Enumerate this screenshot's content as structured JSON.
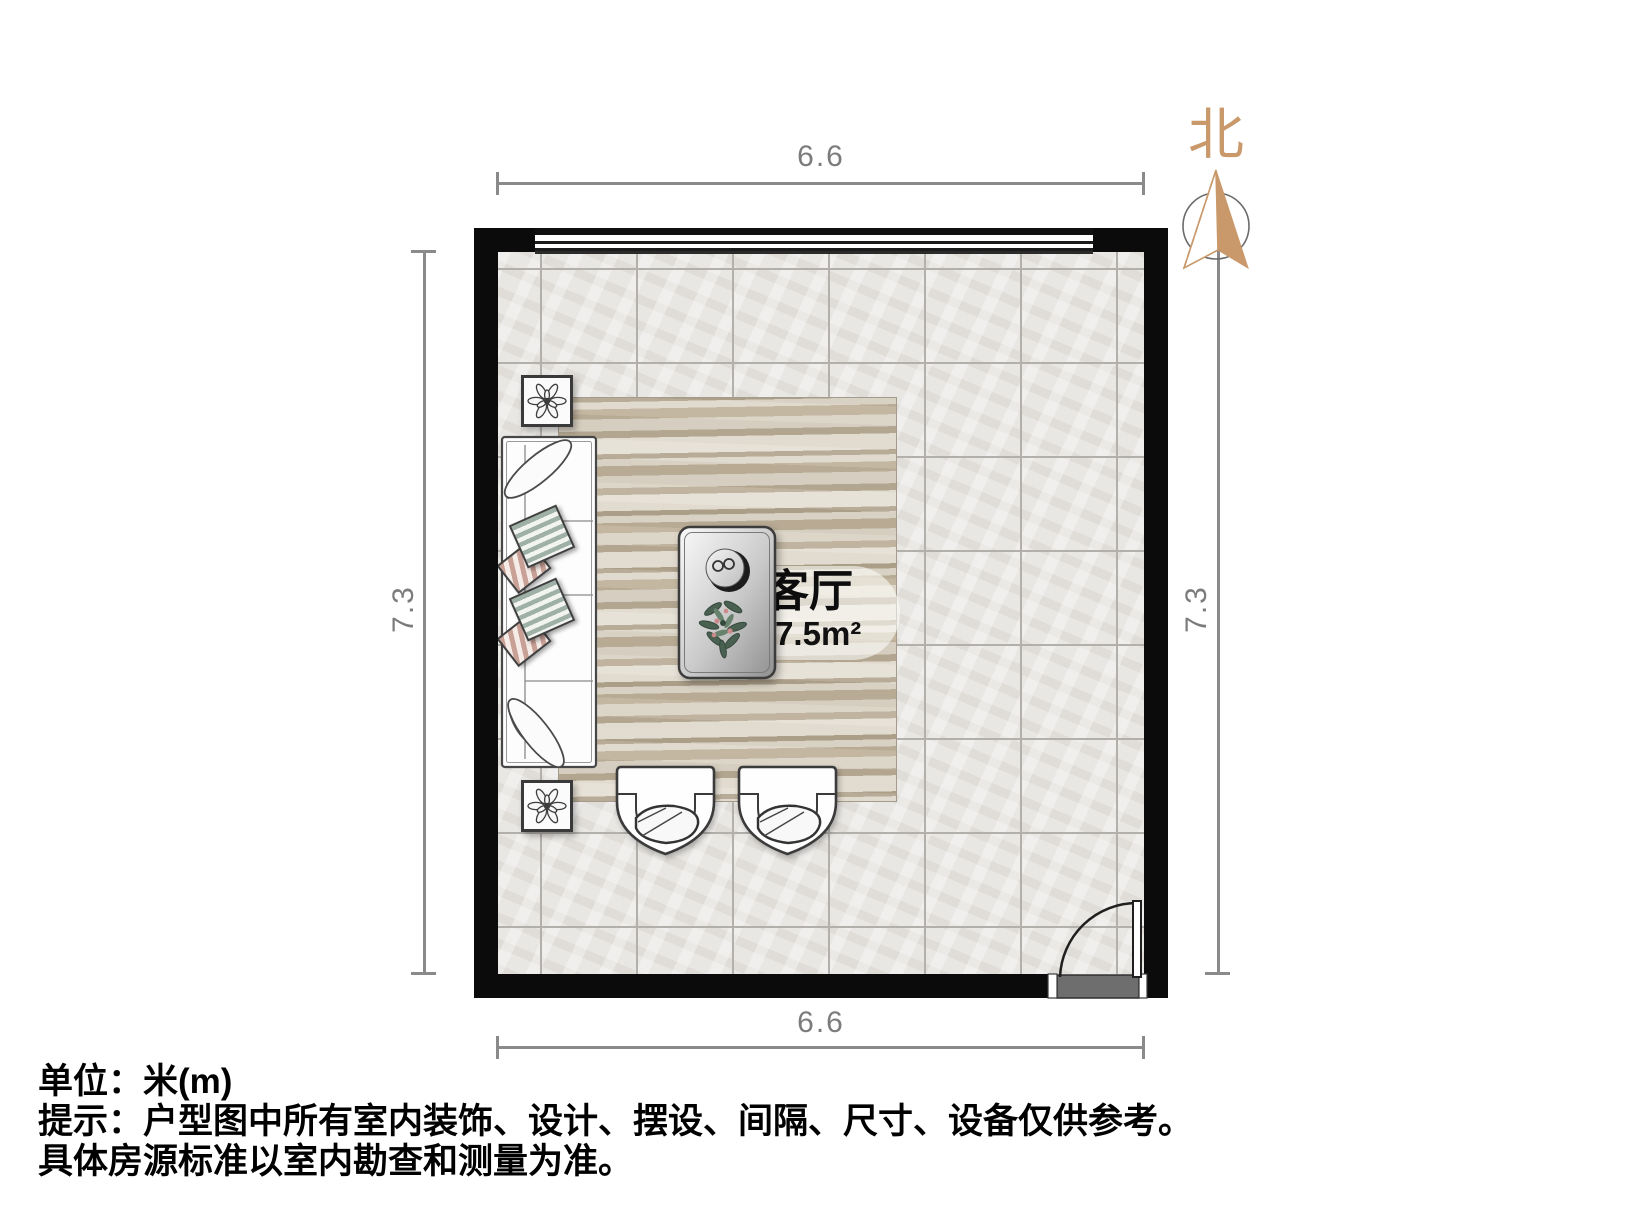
{
  "north": {
    "label": "北",
    "color": "#C9996B"
  },
  "dimensions": {
    "top": "6.6",
    "bottom": "6.6",
    "left": "7.3",
    "right": "7.3",
    "line_color": "#8a8a8a"
  },
  "room": {
    "name": "客厅",
    "area": "47.5m²"
  },
  "footer": {
    "line1": "单位：米(m)",
    "line2": "提示：户型图中所有室内装饰、设计、摆设、间隔、尺寸、设备仅供参考。",
    "line3": "具体房源标准以室内勘查和测量为准。"
  },
  "colors": {
    "wall": "#0b0b0b",
    "floor": "#e9e7e3",
    "rug": "#cdc4b2",
    "accent": "#C9996B",
    "dimension": "#8a8a8a"
  }
}
